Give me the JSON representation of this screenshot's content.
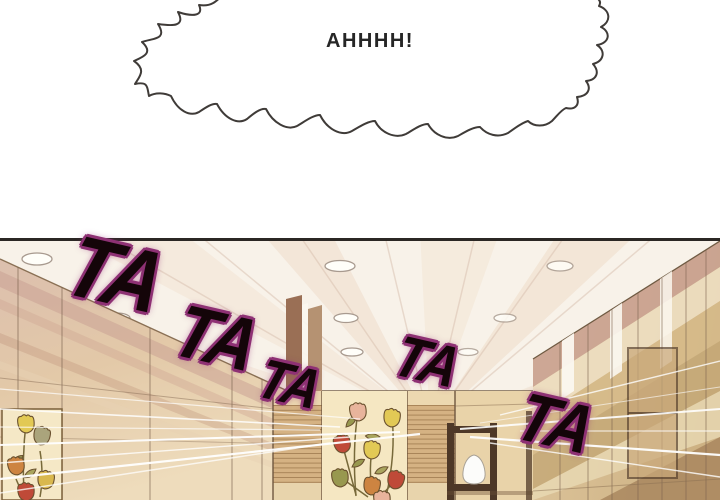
{
  "speech_bubble": {
    "text": "AHHHH!"
  },
  "sfx": {
    "items": [
      {
        "text": "TA"
      },
      {
        "text": "TA"
      },
      {
        "text": "TA"
      },
      {
        "text": "TA"
      },
      {
        "text": "TA"
      }
    ]
  },
  "colors": {
    "sfx_fill": "#140509",
    "sfx_outline": "#8e3174",
    "panel_border": "#2b2724",
    "ceiling": "#f8f2e9",
    "wood_light": "#e6cfa6",
    "wood_mid": "#d5b283",
    "wood_dark": "#8a6a4a",
    "rose_tint": "#c99f96",
    "mural_bg": "#f5e7c4",
    "tulip_red": "#bf4a38",
    "tulip_orange": "#cd8441",
    "tulip_yellow": "#e2c955",
    "tulip_blush": "#e8b49c",
    "tulip_olive": "#98984f"
  }
}
